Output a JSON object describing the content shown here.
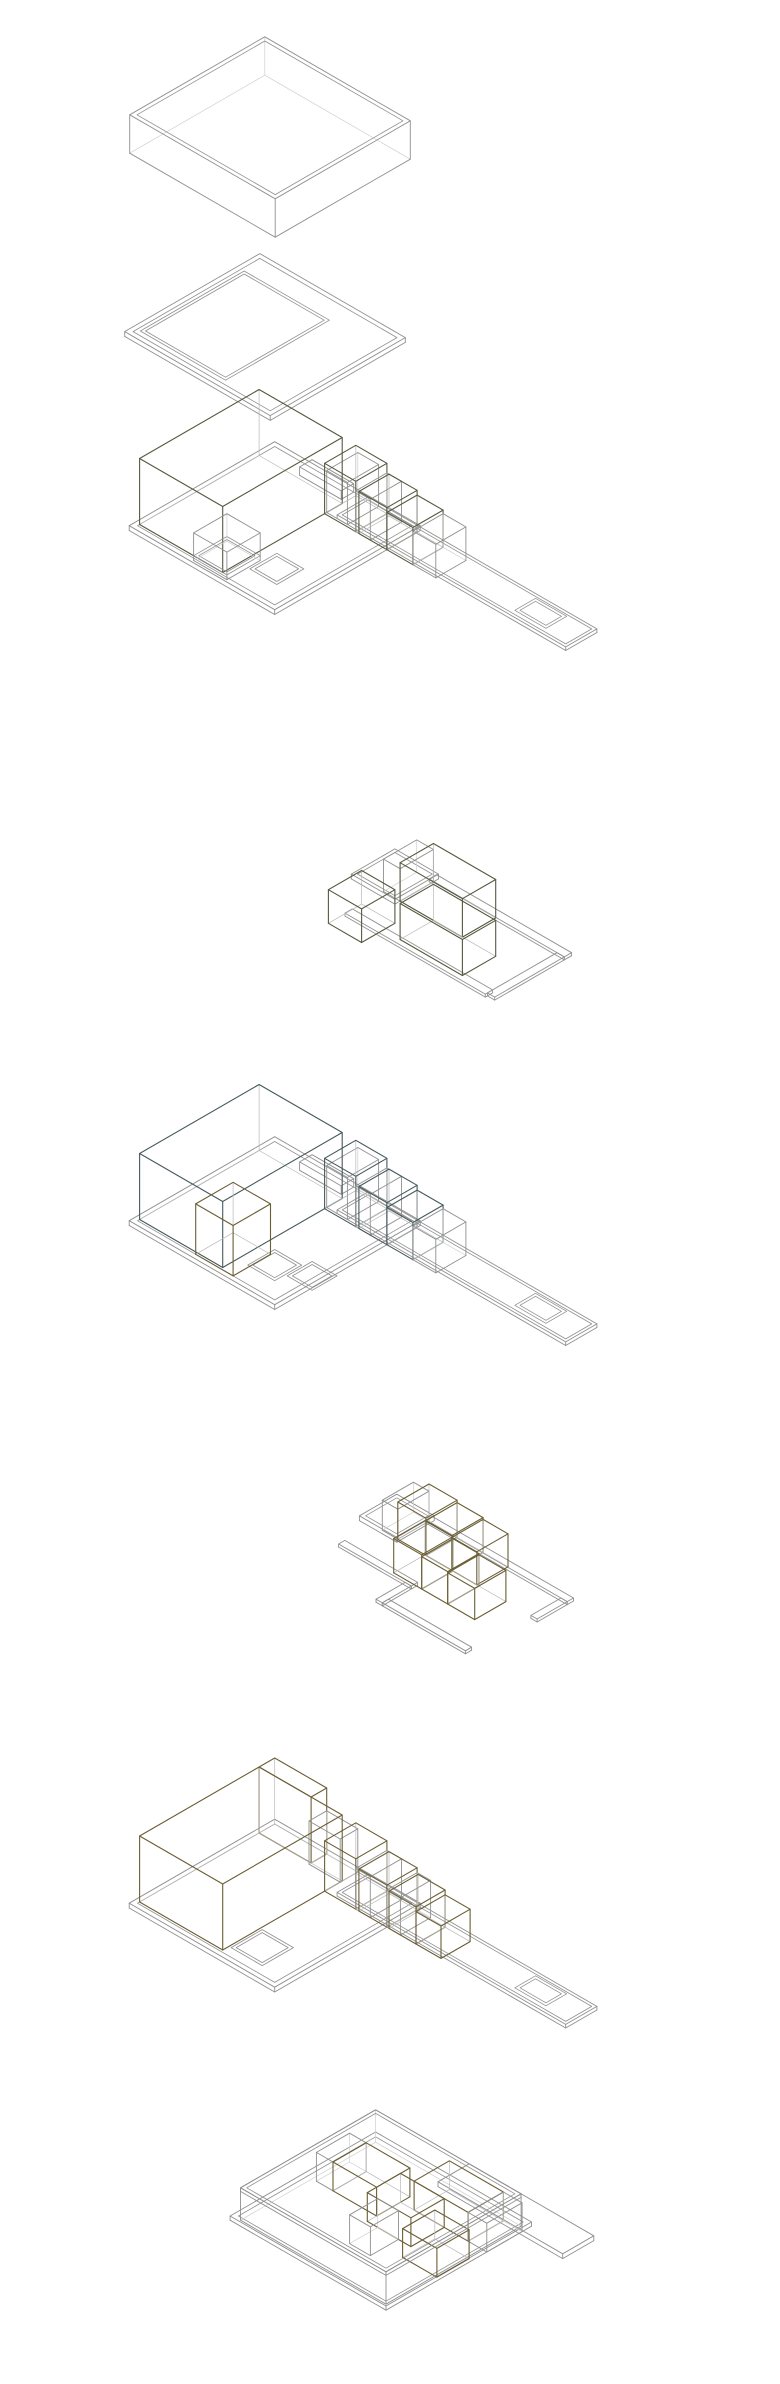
{
  "figure": {
    "type": "exploded-axonometric-diagram",
    "background": "#ffffff",
    "projection": {
      "ux": 10.392,
      "vy": 6,
      "vz": 12
    },
    "palette": {
      "green": {
        "top": "#dfe5c7",
        "left": "#d6deb8",
        "right": "#ccd6aa",
        "edge": "#54593f"
      },
      "blue": {
        "top": "#c2d1d1",
        "left": "#afc5c7",
        "right": "#a0babd",
        "edge": "#46595d"
      },
      "yellow": {
        "top": "#eedfab",
        "left": "#e9d79d",
        "right": "#e2cd8c",
        "edge": "#6a5e34"
      },
      "wire_stroke": "#909090",
      "wire_hidden": "#cfcfcf",
      "solid_hidden": "#b8b8b8",
      "fill_opacity": 0.84
    },
    "layers": [
      {
        "id": "roof-volume",
        "alt": "transparent wireframe roof box with double-line top rim",
        "cx": 270,
        "cy": 137,
        "prims": [
          {
            "k": "wbox",
            "x": 0,
            "y": 0,
            "w": 14,
            "d": 13,
            "h": 3.2,
            "rim": 0.35
          }
        ]
      },
      {
        "id": "roof-slab",
        "alt": "thin flat roof plate with rim and inner panel seam",
        "cx": 265,
        "cy": 337,
        "prims": [
          {
            "k": "slab",
            "x": 0,
            "y": 0,
            "w": 14,
            "d": 13,
            "h": 0.4,
            "rim": 0.4
          },
          {
            "k": "hole",
            "x": 0.7,
            "y": 2.2,
            "w": 8.2,
            "d": 10,
            "z": 0.4
          }
        ]
      },
      {
        "id": "second-floor-walls",
        "alt": "large translucent green volume with row of green boxes on floor plate and white wire box at front",
        "cx": 363,
        "cy": 520,
        "prims": [
          {
            "k": "slab",
            "x": 0,
            "y": 0,
            "w": 14,
            "d": 14,
            "h": 0.4,
            "rim": 0.4
          },
          {
            "k": "slab",
            "x": 9,
            "y": 0,
            "w": 22,
            "d": 3,
            "h": 0.3,
            "rim": 0.25
          },
          {
            "k": "hole",
            "x": 9.4,
            "y": 9.2,
            "w": 2.6,
            "d": 2.6,
            "z": 0.4
          },
          {
            "k": "hole",
            "x": 25.5,
            "y": 0.4,
            "w": 3,
            "d": 2,
            "z": 0.3
          },
          {
            "k": "slab",
            "x": 3.6,
            "y": 0,
            "w": 4,
            "d": 1.2,
            "h": 0.7
          },
          {
            "k": "wbox",
            "x": 8,
            "y": 0,
            "w": 2,
            "d": 3,
            "h": 3.5
          },
          {
            "k": "box",
            "c": "green",
            "x": 0,
            "y": 1.5,
            "w": 8,
            "d": 11.5,
            "h": 5.5
          },
          {
            "k": "box",
            "c": "green",
            "x": 8,
            "y": 0.2,
            "w": 3,
            "d": 3,
            "h": 4.2
          },
          {
            "k": "wbox",
            "x": 11,
            "y": 0.2,
            "w": 1.4,
            "d": 3,
            "h": 3.4
          },
          {
            "k": "box",
            "c": "green",
            "x": 11.3,
            "y": 0.3,
            "w": 2.7,
            "d": 2.9,
            "h": 3.5
          },
          {
            "k": "box",
            "c": "green",
            "x": 14,
            "y": 0.3,
            "w": 2.5,
            "d": 2.9,
            "h": 3.1
          },
          {
            "k": "wbox",
            "x": 16.5,
            "y": 0.3,
            "w": 2.2,
            "d": 2.9,
            "h": 2.8
          },
          {
            "k": "hole",
            "x": 5.6,
            "y": 10.2,
            "w": 3.2,
            "d": 3.2,
            "z": 0.4
          },
          {
            "k": "wbox",
            "x": 5.6,
            "y": 10.2,
            "w": 3.2,
            "d": 3.2,
            "h": 2.3
          }
        ]
      },
      {
        "id": "second-floor-volumes",
        "alt": "two long green boxes and one small green box on partial corridor frame",
        "cx": 450,
        "cy": 920,
        "prims": [
          {
            "k": "slab",
            "x": 0,
            "y": 0,
            "w": 4.2,
            "d": 4.2,
            "h": 0.4,
            "rim": 0.3
          },
          {
            "k": "slab",
            "x": 4,
            "y": 0,
            "w": 13,
            "d": 0.7,
            "h": 0.25
          },
          {
            "k": "slab",
            "x": 16.3,
            "y": 0.7,
            "w": 0.7,
            "d": 6.7,
            "h": 0.25
          },
          {
            "k": "slab",
            "x": 2.8,
            "y": 6.9,
            "w": 13.5,
            "d": 0.7,
            "h": 0.25
          },
          {
            "k": "wbox",
            "x": 2.6,
            "y": 0.5,
            "w": 1.6,
            "d": 3.2,
            "h": 2.7
          },
          {
            "k": "box",
            "c": "green",
            "x": 4.2,
            "y": 0.5,
            "w": 6,
            "d": 3.2,
            "h": 3.2
          },
          {
            "k": "box",
            "c": "green",
            "x": 7.4,
            "y": 3.7,
            "w": 6,
            "d": 3.2,
            "h": 3
          },
          {
            "k": "box",
            "c": "green",
            "x": 2.6,
            "y": 5.8,
            "w": 3.2,
            "d": 3.2,
            "h": 2.8
          }
        ]
      },
      {
        "id": "first-floor-walls",
        "alt": "large translucent blue-gray volume with row of blue boxes and a yellow cube at front",
        "cx": 363,
        "cy": 1215,
        "prims": [
          {
            "k": "slab",
            "x": 0,
            "y": 0,
            "w": 14,
            "d": 14,
            "h": 0.4,
            "rim": 0.4
          },
          {
            "k": "slab",
            "x": 9,
            "y": 0,
            "w": 22,
            "d": 3,
            "h": 0.3,
            "rim": 0.25
          },
          {
            "k": "hole",
            "x": 9.4,
            "y": 9.4,
            "w": 2.6,
            "d": 2.6,
            "z": 0.4
          },
          {
            "k": "hole",
            "x": 12.2,
            "y": 8.6,
            "w": 2.4,
            "d": 2.4,
            "z": 0.4
          },
          {
            "k": "hole",
            "x": 25.5,
            "y": 0.4,
            "w": 3,
            "d": 2,
            "z": 0.3
          },
          {
            "k": "slab",
            "x": 3.6,
            "y": 0,
            "w": 4,
            "d": 1.2,
            "h": 0.7
          },
          {
            "k": "wbox",
            "x": 8,
            "y": 0,
            "w": 2,
            "d": 3,
            "h": 3.5
          },
          {
            "k": "box",
            "c": "blue",
            "x": 0,
            "y": 1.5,
            "w": 8,
            "d": 11.5,
            "h": 5.5
          },
          {
            "k": "box",
            "c": "blue",
            "x": 8,
            "y": 0.2,
            "w": 3,
            "d": 3,
            "h": 4.2
          },
          {
            "k": "wbox",
            "x": 11,
            "y": 0.2,
            "w": 1.4,
            "d": 3,
            "h": 3.4
          },
          {
            "k": "box",
            "c": "blue",
            "x": 11.3,
            "y": 0.3,
            "w": 2.7,
            "d": 2.9,
            "h": 3.5
          },
          {
            "k": "box",
            "c": "blue",
            "x": 14,
            "y": 0.3,
            "w": 2.5,
            "d": 2.9,
            "h": 3.1
          },
          {
            "k": "wbox",
            "x": 16.5,
            "y": 0.3,
            "w": 2.2,
            "d": 2.9,
            "h": 2.8
          },
          {
            "k": "box",
            "c": "yellow",
            "x": 5.6,
            "y": 9.6,
            "w": 3.6,
            "d": 3.6,
            "h": 4.2
          }
        ]
      },
      {
        "id": "first-floor-volumes",
        "alt": "two rows of yellow room boxes on meandering floor-edge frame with white wire box at left",
        "cx": 456,
        "cy": 1568,
        "prims": [
          {
            "k": "slab",
            "x": 0,
            "y": 0,
            "w": 3.6,
            "d": 3.6,
            "h": 0.4,
            "rim": 0.3
          },
          {
            "k": "slab",
            "x": 3.4,
            "y": 0,
            "w": 13.6,
            "d": 0.6,
            "h": 0.25
          },
          {
            "k": "slab",
            "x": 16.4,
            "y": 0.6,
            "w": 0.6,
            "d": 2.9,
            "h": 0.25
          },
          {
            "k": "slab",
            "x": 1.2,
            "y": 6.2,
            "w": 7,
            "d": 0.6,
            "h": 0.25
          },
          {
            "k": "slab",
            "x": 7.6,
            "y": 6.8,
            "w": 0.6,
            "d": 2.8,
            "h": 0.25
          },
          {
            "k": "slab",
            "x": 8.2,
            "y": 9,
            "w": 8,
            "d": 0.6,
            "h": 0.25
          },
          {
            "k": "wbox",
            "x": 1.9,
            "y": 0.3,
            "w": 1.5,
            "d": 3,
            "h": 2.5
          },
          {
            "k": "box",
            "c": "yellow",
            "x": 3.4,
            "y": 0.3,
            "w": 2.7,
            "d": 3,
            "h": 3.1
          },
          {
            "k": "box",
            "c": "yellow",
            "x": 6.1,
            "y": 0.3,
            "w": 2.5,
            "d": 3,
            "h": 2.9
          },
          {
            "k": "box",
            "c": "yellow",
            "x": 8.6,
            "y": 0.3,
            "w": 2.4,
            "d": 3,
            "h": 2.75
          },
          {
            "k": "box",
            "c": "yellow",
            "x": 6,
            "y": 3.3,
            "w": 2.7,
            "d": 3,
            "h": 2.85
          },
          {
            "k": "box",
            "c": "yellow",
            "x": 8.7,
            "y": 3.3,
            "w": 2.5,
            "d": 3,
            "h": 2.7
          },
          {
            "k": "box",
            "c": "yellow",
            "x": 11.2,
            "y": 3.3,
            "w": 2.6,
            "d": 3,
            "h": 2.6
          }
        ]
      },
      {
        "id": "ground-floor-walls",
        "alt": "large translucent yellow L-shaped volume with row of yellow boxes on floor plate",
        "cx": 363,
        "cy": 1893,
        "prims": [
          {
            "k": "slab",
            "x": 0,
            "y": 0,
            "w": 14,
            "d": 14,
            "h": 0.4,
            "rim": 0.4
          },
          {
            "k": "slab",
            "x": 9,
            "y": 0,
            "w": 22,
            "d": 3,
            "h": 0.3,
            "rim": 0.25
          },
          {
            "k": "hole",
            "x": 8.6,
            "y": 9.8,
            "w": 3,
            "d": 3,
            "z": 0.4
          },
          {
            "k": "hole",
            "x": 25.5,
            "y": 0.4,
            "w": 3,
            "d": 2,
            "z": 0.3
          },
          {
            "k": "box",
            "c": "yellow",
            "x": 0,
            "y": 0,
            "w": 5,
            "d": 1.5,
            "h": 5.5
          },
          {
            "k": "wbox",
            "x": 5,
            "y": 0,
            "w": 3,
            "d": 1.7,
            "h": 3.6
          },
          {
            "k": "box",
            "c": "yellow",
            "x": 0,
            "y": 1.5,
            "w": 8,
            "d": 11.5,
            "h": 5.5
          },
          {
            "k": "box",
            "c": "yellow",
            "x": 8,
            "y": 0.2,
            "w": 3,
            "d": 3,
            "h": 4.2
          },
          {
            "k": "wbox",
            "x": 11,
            "y": 0.2,
            "w": 1.4,
            "d": 3,
            "h": 3.4
          },
          {
            "k": "box",
            "c": "yellow",
            "x": 11.3,
            "y": 0.3,
            "w": 2.7,
            "d": 2.9,
            "h": 3.5
          },
          {
            "k": "wbox",
            "x": 14,
            "y": 0.3,
            "w": 1.3,
            "d": 2.9,
            "h": 3.1
          },
          {
            "k": "box",
            "c": "yellow",
            "x": 14.2,
            "y": 0.4,
            "w": 2.6,
            "d": 2.8,
            "h": 3.1
          },
          {
            "k": "box",
            "c": "yellow",
            "x": 16.8,
            "y": 0.4,
            "w": 2.4,
            "d": 2.8,
            "h": 2.7
          }
        ]
      },
      {
        "id": "basement-volumes",
        "alt": "wireframe basement tray containing yellow room boxes and white wire partitions",
        "cx": 412,
        "cy": 2210,
        "prims": [
          {
            "k": "slab",
            "x": -0.5,
            "y": -0.5,
            "w": 15,
            "d": 14,
            "h": 0.35,
            "rim": 0.4
          },
          {
            "k": "wbox",
            "x": 0,
            "y": 0,
            "w": 14,
            "d": 13,
            "h": 2.7,
            "rim": 0.3
          },
          {
            "k": "slab",
            "x": 9,
            "y": 0,
            "w": 12,
            "d": 3,
            "h": 0.4,
            "z": 2.3
          },
          {
            "k": "box",
            "c": "yellow",
            "x": 7.5,
            "y": 0.4,
            "w": 5.2,
            "d": 3.4,
            "h": 2.4
          },
          {
            "k": "wbox",
            "x": 12.7,
            "y": 0.4,
            "w": 1.8,
            "d": 3.4,
            "h": 2.4
          },
          {
            "k": "wbox",
            "x": 0.4,
            "y": 2.9,
            "w": 1.6,
            "d": 3.2,
            "h": 2.4
          },
          {
            "k": "box",
            "c": "yellow",
            "x": 2,
            "y": 2.9,
            "w": 4.2,
            "d": 3.2,
            "h": 2.4
          },
          {
            "k": "box",
            "c": "yellow",
            "x": 6.2,
            "y": 3.8,
            "w": 4.2,
            "d": 3.2,
            "h": 2.4
          },
          {
            "k": "box",
            "c": "yellow",
            "x": 10.9,
            "y": 5.2,
            "w": 3.3,
            "d": 3.1,
            "h": 2.4
          },
          {
            "k": "wbox",
            "x": 7.2,
            "y": 7,
            "w": 2,
            "d": 2.7,
            "h": 2.4
          },
          {
            "k": "slab",
            "x": 0,
            "y": 0,
            "w": 14,
            "d": 13,
            "h": 0.3,
            "z": 2.4
          }
        ]
      }
    ]
  }
}
